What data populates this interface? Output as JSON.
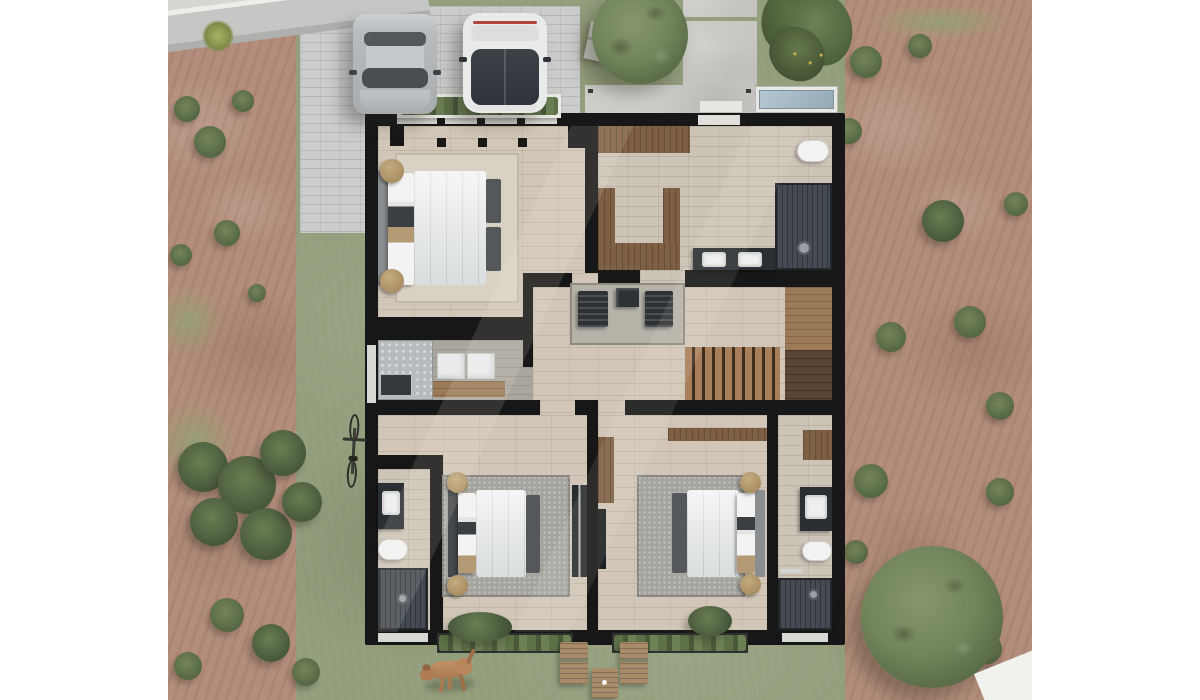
{
  "scene": {
    "description": "Photorealistic top-down 3D architectural render of a house upper-floor plan surrounded by its yard",
    "view": "top-down site plan",
    "canvas": {
      "width": 1200,
      "height": 700,
      "render_area_left": 168,
      "render_area_width": 864
    }
  },
  "palette": {
    "bg": "#ffffff",
    "grass": "#929e7c",
    "grassLight": "#a3ae8a",
    "dirt": "#b48e7c",
    "dirtDark": "#a37c6a",
    "road": "#c5c7c4",
    "sidewalk": "#d6d7d3",
    "curb": "#edeeea",
    "paver": "#cccccb",
    "concrete": "#c8c7c3",
    "pool": "#a2b8c4",
    "poolRim": "#e8e9e5",
    "wall": "#171717",
    "woodFloor": "#d1c6b7",
    "tile": "#cdc4b8",
    "grayTile": "#aaa69e",
    "woodDark": "#7e6044",
    "woodMid": "#9c7a57",
    "stairTread": "#a87f5c",
    "stairGap": "#3f2d1e",
    "landing": "#5c4533",
    "shower": "#454b52",
    "counter": "#2b2f33",
    "fixture": "#f1f2f1",
    "duvet": "#e8eae9",
    "headboard": "#8b8e90",
    "pillowDark": "#3b3f43",
    "tan": "#b39a74",
    "rugLight": "#d9d2c4",
    "rugGray": "#a4a39d",
    "tree": "#72855c",
    "carSilver": "#b5b8ba",
    "carWhite": "#e9eaea",
    "glass": "#3a3f45",
    "windowGlass": "#d7d9d4",
    "tailLight": "#b0473f",
    "dog": "#b9855d",
    "benchWood": "#a88c6a",
    "appliance": "#e9ebeb",
    "laundryGlass": "#b6bcbe"
  },
  "landscape": {
    "areas": [
      {
        "name": "road",
        "desc": "diagonal street with curb and sidewalk, top-left corner"
      },
      {
        "name": "paver-driveway",
        "desc": "gray brick paver driveway with two parked cars"
      },
      {
        "name": "front-lawn",
        "desc": "lawn with tree, small garden shed and two concrete slabs"
      },
      {
        "name": "entry-walkway",
        "desc": "concrete path leading to the front door"
      },
      {
        "name": "plunge-pool",
        "desc": "small rectangular pool beside the entry"
      },
      {
        "name": "left-yard",
        "desc": "bare earth with shrubs, grass strip along the house"
      },
      {
        "name": "right-yard",
        "desc": "bare earth with scattered shrubs and a large tree"
      },
      {
        "name": "rear-lawn",
        "desc": "back lawn with two wooden loungers, side table and a dog"
      }
    ],
    "trees": [
      {
        "name": "front-yard-tree"
      },
      {
        "name": "rear-yard-tree"
      }
    ],
    "objects": [
      "garden-shed",
      "bicycle",
      "wooden-lounger x2",
      "wooden-side-table",
      "window-planter x3",
      "dog"
    ],
    "bushes": [
      {
        "x": 28,
        "y": 14,
        "d": 44,
        "k": "palm"
      },
      {
        "x": 6,
        "y": 96,
        "d": 26,
        "k": "bush"
      },
      {
        "x": 64,
        "y": 90,
        "d": 22,
        "k": "bush"
      },
      {
        "x": 26,
        "y": 126,
        "d": 32,
        "k": "bush"
      },
      {
        "x": 46,
        "y": 220,
        "d": 26,
        "k": "bush"
      },
      {
        "x": 2,
        "y": 244,
        "d": 22,
        "k": "bush"
      },
      {
        "x": 80,
        "y": 284,
        "d": 18,
        "k": "bush"
      },
      {
        "x": -14,
        "y": 286,
        "d": 70,
        "k": "patch"
      },
      {
        "x": -16,
        "y": 400,
        "d": 84,
        "k": "patch"
      },
      {
        "x": 10,
        "y": 442,
        "d": 50,
        "k": "shrub"
      },
      {
        "x": 50,
        "y": 456,
        "d": 58,
        "k": "shrub"
      },
      {
        "x": 92,
        "y": 430,
        "d": 46,
        "k": "shrub"
      },
      {
        "x": 22,
        "y": 498,
        "d": 48,
        "k": "shrub"
      },
      {
        "x": 72,
        "y": 508,
        "d": 52,
        "k": "shrub"
      },
      {
        "x": 114,
        "y": 482,
        "d": 40,
        "k": "shrub"
      },
      {
        "x": 42,
        "y": 598,
        "d": 34,
        "k": "bush"
      },
      {
        "x": 84,
        "y": 624,
        "d": 38,
        "k": "shrub"
      },
      {
        "x": 6,
        "y": 652,
        "d": 28,
        "k": "bush"
      },
      {
        "x": 124,
        "y": 658,
        "d": 28,
        "k": "bush"
      },
      {
        "x": 697,
        "y": 4,
        "w": 150,
        "h": 36,
        "k": "patch"
      },
      {
        "x": 682,
        "y": 46,
        "d": 32,
        "k": "bush"
      },
      {
        "x": 740,
        "y": 34,
        "d": 24,
        "k": "bush"
      },
      {
        "x": 668,
        "y": 118,
        "d": 26,
        "k": "bush"
      },
      {
        "x": 754,
        "y": 200,
        "d": 42,
        "k": "shrub"
      },
      {
        "x": 836,
        "y": 192,
        "d": 24,
        "k": "bush"
      },
      {
        "x": 708,
        "y": 322,
        "d": 30,
        "k": "bush"
      },
      {
        "x": 786,
        "y": 306,
        "d": 32,
        "k": "bush"
      },
      {
        "x": 818,
        "y": 392,
        "d": 28,
        "k": "bush"
      },
      {
        "x": 686,
        "y": 464,
        "d": 34,
        "k": "bush"
      },
      {
        "x": 818,
        "y": 478,
        "d": 28,
        "k": "bush"
      },
      {
        "x": 676,
        "y": 540,
        "d": 24,
        "k": "bush"
      },
      {
        "x": 804,
        "y": 634,
        "d": 30,
        "k": "bush"
      }
    ]
  },
  "vehicles": [
    {
      "name": "silver-sedan",
      "color": "#b5b8ba",
      "location": "driveway left stall, parked nose toward house"
    },
    {
      "name": "white-car",
      "color": "#e9eaea",
      "location": "driveway right stall, parked nose toward house"
    }
  ],
  "house": {
    "outline": "black structural walls, top-down cutaway",
    "rooms": [
      {
        "name": "master-bedroom",
        "floor": "light oak plank",
        "furniture": [
          "double bed with gray bedding",
          "cream area rug",
          "2 rattan poufs"
        ]
      },
      {
        "name": "master-bath-and-closet",
        "floor": "beige tile",
        "furniture": [
          "wood cabinets",
          "U-shaped walk-in closet",
          "double vanity with 2 sinks",
          "walk-in shower",
          "toilet"
        ]
      },
      {
        "name": "laundry",
        "floor": "gray tile",
        "furniture": [
          "washer",
          "dryer",
          "wood counter",
          "frosted glass screen"
        ]
      },
      {
        "name": "hallway-landing",
        "floor": "light oak plank",
        "furniture": [
          "gray rug",
          "2 easy chairs",
          "side table",
          "wood staircase",
          "dark wood landing"
        ]
      },
      {
        "name": "bedroom-2",
        "floor": "light oak plank",
        "furniture": [
          "double bed",
          "gray shag rug",
          "2 rattan poufs",
          "sliding wardrobe",
          "foot bench"
        ]
      },
      {
        "name": "bathroom-2",
        "floor": "beige tile",
        "furniture": [
          "vanity with sink",
          "toilet",
          "walk-in shower"
        ]
      },
      {
        "name": "bedroom-3",
        "floor": "light oak plank",
        "furniture": [
          "double bed",
          "gray shag rug",
          "2 rattan poufs",
          "L-shaped desk",
          "tv panel",
          "foot bench"
        ]
      },
      {
        "name": "bathroom-3",
        "floor": "beige tile",
        "furniture": [
          "vanity with sink",
          "toilet",
          "walk-in shower",
          "wood shelf",
          "towel rail"
        ]
      }
    ],
    "openings": [
      "front-door on top wall",
      "master-bedroom window with planter box",
      "bedroom-2 window with planter box",
      "bedroom-3 window with planter box",
      "laundry window on left wall"
    ]
  }
}
